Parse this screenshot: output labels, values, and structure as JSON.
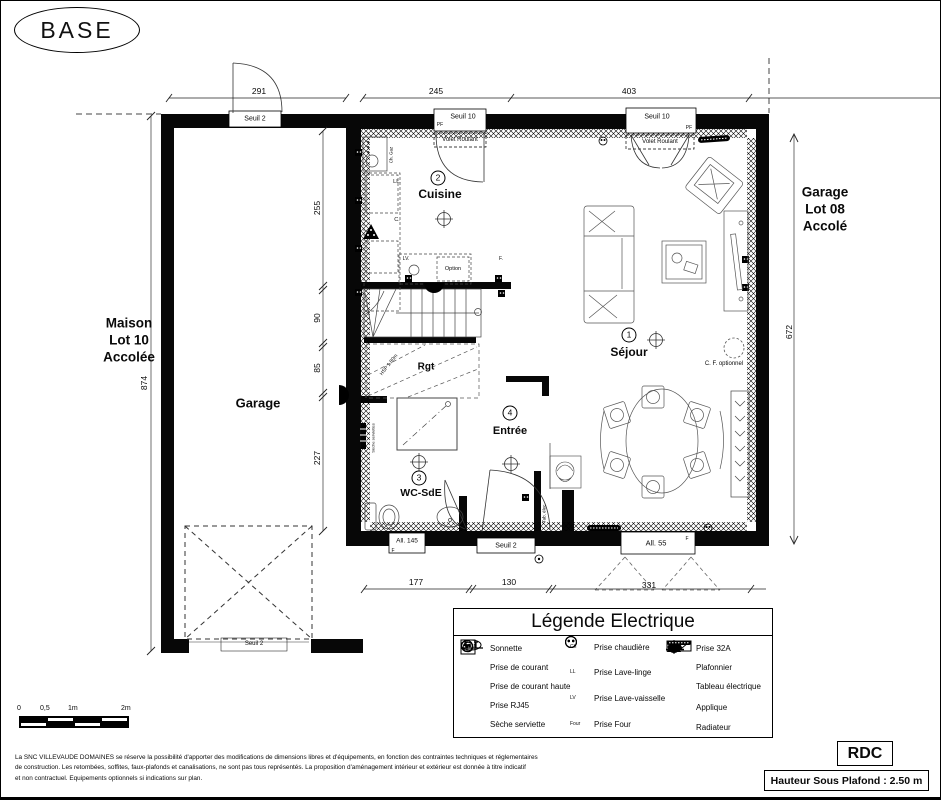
{
  "page": {
    "badge": "BASE",
    "floor": "RDC",
    "ceiling": "Hauteur Sous Plafond : 2.50 m",
    "disclaimer": [
      "La SNC VILLEVAUDE DOMAINES se réserve la possibilité d'apporter des modifications de dimensions libres et d'équipements, en fonction des contraintes techniques et réglementaires",
      "de construction. Les retombées, soffites, faux-plafonds et canalisations, ne sont pas tous représentés. La proposition d'aménagement intérieur et extérieur est donnée à titre indicatif",
      "et non contractuel. Equipements optionnels si indications sur plan."
    ]
  },
  "context": {
    "left": [
      "Maison",
      "Lot 10",
      "Accolée"
    ],
    "right": [
      "Garage",
      "Lot 08",
      "Accolé"
    ]
  },
  "rooms": {
    "sejour": {
      "num": "1",
      "name": "Séjour"
    },
    "cuisine": {
      "num": "2",
      "name": "Cuisine"
    },
    "wc": {
      "num": "3",
      "name": "WC-SdE"
    },
    "entree": {
      "num": "4",
      "name": "Entrée"
    },
    "garage": {
      "name": "Garage"
    },
    "rgt": {
      "name": "Rgt"
    }
  },
  "dims": {
    "top": [
      "291",
      "245",
      "403"
    ],
    "bottom": [
      "177",
      "130",
      "331"
    ],
    "left_outer": "874",
    "left_inner": [
      "255",
      "90",
      "85",
      "227"
    ],
    "right": "672"
  },
  "openings": {
    "seuil2": "Seuil 2",
    "seuil10": "Seuil 10",
    "volet": "Volet Roulant",
    "all145": "All. 145",
    "all55": "All. 55",
    "pf": "PF",
    "f": "F"
  },
  "notes": {
    "ch_gaz": "Ch. Gaz",
    "ll": "LL.",
    "c": "C.",
    "lv": "LV.",
    "f": "F.",
    "option": "Option",
    "hsp": "HSP 1.80m",
    "seche": "Sèche serviettes",
    "tab": "Tab. élec.",
    "cf": "C. F. optionnel"
  },
  "scalebar": {
    "t0": "0",
    "t05": "0,5",
    "t1": "1m",
    "t2": "2m"
  },
  "legend": {
    "title": "Légende Electrique",
    "col1": [
      {
        "icon": "sonnette-icon",
        "label": "Sonnette"
      },
      {
        "icon": "prise-courant-icon",
        "label": "Prise de courant"
      },
      {
        "icon": "prise-courant-haute-icon",
        "label": "Prise de courant haute"
      },
      {
        "icon": "prise-rj45-icon",
        "label": "Prise RJ45",
        "icon_text": "RJ45"
      },
      {
        "icon": "seche-serviette-icon",
        "label": "Sèche serviette"
      }
    ],
    "col2": [
      {
        "icon": "prise-chaudiere-icon",
        "tag": "Ch",
        "label": "Prise chaudière"
      },
      {
        "icon": "prise-lave-linge-icon",
        "tag": "LL",
        "label": "Prise Lave-linge"
      },
      {
        "icon": "prise-lave-vaisselle-icon",
        "tag": "LV",
        "label": "Prise Lave-vaisselle"
      },
      {
        "icon": "prise-four-icon",
        "tag": "Four",
        "label": "Prise Four"
      }
    ],
    "col3": [
      {
        "icon": "prise-32a-icon",
        "label": "Prise 32A"
      },
      {
        "icon": "plafonnier-icon",
        "label": "Plafonnier"
      },
      {
        "icon": "tableau-electrique-icon",
        "label": "Tableau électrique"
      },
      {
        "icon": "applique-icon",
        "label": "Applique"
      },
      {
        "icon": "radiateur-icon",
        "label": "Radiateur"
      }
    ]
  }
}
